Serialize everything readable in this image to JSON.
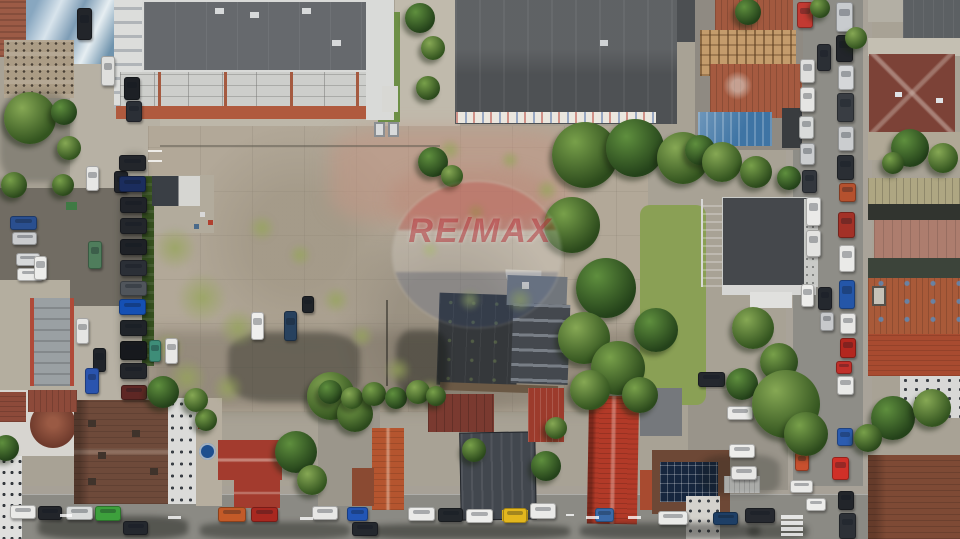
{
  "scene": {
    "type": "aerial-drone-photo",
    "description": "Top-down drone photo of an urban block: large vacant concrete lot in the center with a dark saw-tooth factory roof, a modern apartment building and dark warehouse roof at top, tree-lined vertical streets left and right packed with parked cars, and a row of tiled-roof houses along the bottom street.",
    "watermark": {
      "brand": "RE/MAX"
    }
  },
  "palette": {
    "ground_concrete": "#a8a295",
    "lot_concrete": "#b2a898",
    "lot_pink": "#bb9d8c",
    "asphalt": "#8d8c86",
    "asphalt_dark": "#716c63",
    "roof_apartment": "#66696d",
    "roof_warehouse": "#55585b",
    "roof_office": "#45484c",
    "roof_sawtooth": "#3b3e42",
    "tile_red": "#a4503a",
    "tile_bright": "#b23a28",
    "roof_maroon": "#7c4237",
    "roof_brown": "#6e4a3a",
    "roof_blue": "#3e74a4",
    "vegetation": "#4c7030",
    "grass": "#8aa055",
    "watermark_red": "#ac1e24",
    "car_white": "#eaeae8"
  },
  "structures": [
    {
      "name": "apartment-building",
      "roof": "#66696d"
    },
    {
      "name": "warehouse",
      "roof": "#55585b"
    },
    {
      "name": "vacant-lot",
      "surface": "#b2a898"
    },
    {
      "name": "sawtooth-factory",
      "roof": "#3b3e42"
    },
    {
      "name": "office-building",
      "roof": "#45484c"
    },
    {
      "name": "ruined-tile-buildings",
      "roof": "#a4503a"
    },
    {
      "name": "blue-metal-roof",
      "roof": "#3e74a4"
    },
    {
      "name": "maroon-roof-house",
      "roof": "#7c4237"
    },
    {
      "name": "turret-house",
      "roof": "#6e4a3a"
    },
    {
      "name": "modern-dark-house",
      "roof": "#42474e"
    },
    {
      "name": "red-tile-house",
      "roof": "#b23a28"
    },
    {
      "name": "solar-panel-house",
      "roof": "#6d4836"
    },
    {
      "name": "garage-row",
      "roof": "#9aa0a3"
    }
  ],
  "cars": [
    [
      77,
      8,
      15,
      32,
      "#22252a"
    ],
    [
      101,
      56,
      14,
      30,
      "#dfdfdd"
    ],
    [
      124,
      77,
      16,
      23,
      "#1d2025"
    ],
    [
      126,
      101,
      16,
      21,
      "#2b2f36"
    ],
    [
      86,
      166,
      13,
      25,
      "#e7e7e5"
    ],
    [
      114,
      171,
      14,
      22,
      "#202329"
    ],
    [
      119,
      155,
      27,
      16,
      "#23262b"
    ],
    [
      119,
      176,
      27,
      16,
      "#1b2d5e"
    ],
    [
      120,
      197,
      27,
      16,
      "#202329"
    ],
    [
      120,
      218,
      27,
      16,
      "#23262b"
    ],
    [
      120,
      239,
      27,
      16,
      "#1e2126"
    ],
    [
      120,
      260,
      27,
      16,
      "#2b2f36"
    ],
    [
      120,
      281,
      27,
      15,
      "#50555b"
    ],
    [
      119,
      299,
      27,
      16,
      "#1550b4"
    ],
    [
      120,
      320,
      27,
      16,
      "#202429"
    ],
    [
      120,
      341,
      27,
      19,
      "#17191d"
    ],
    [
      120,
      363,
      27,
      16,
      "#23262b"
    ],
    [
      121,
      385,
      26,
      15,
      "#5e2724"
    ],
    [
      88,
      241,
      14,
      28,
      "#4f7d5c"
    ],
    [
      76,
      318,
      13,
      26,
      "#e5e5e3"
    ],
    [
      93,
      348,
      13,
      24,
      "#20242a"
    ],
    [
      85,
      368,
      14,
      26,
      "#2a54ae"
    ],
    [
      149,
      340,
      12,
      22,
      "#3e8d78"
    ],
    [
      165,
      338,
      13,
      26,
      "#e8e8e6"
    ],
    [
      10,
      216,
      27,
      14,
      "#2a4f8f"
    ],
    [
      12,
      232,
      25,
      13,
      "#caccce"
    ],
    [
      16,
      253,
      24,
      13,
      "#d7d9da"
    ],
    [
      17,
      268,
      26,
      13,
      "#e9e9e7"
    ],
    [
      34,
      256,
      13,
      24,
      "#ededeb"
    ],
    [
      251,
      312,
      13,
      28,
      "#efefed"
    ],
    [
      284,
      311,
      13,
      30,
      "#27415e"
    ],
    [
      302,
      296,
      12,
      17,
      "#1f2328"
    ],
    [
      836,
      2,
      17,
      30,
      "#c8cbce"
    ],
    [
      836,
      35,
      17,
      27,
      "#22252a"
    ],
    [
      838,
      65,
      16,
      25,
      "#d5d7d9"
    ],
    [
      837,
      93,
      17,
      29,
      "#393d43"
    ],
    [
      838,
      126,
      16,
      25,
      "#cbcdcf"
    ],
    [
      837,
      155,
      17,
      25,
      "#2a2e34"
    ],
    [
      839,
      183,
      17,
      19,
      "#b5512e"
    ],
    [
      838,
      212,
      17,
      26,
      "#a33127"
    ],
    [
      839,
      245,
      16,
      27,
      "#eaeae8"
    ],
    [
      839,
      280,
      16,
      29,
      "#2456a8"
    ],
    [
      840,
      313,
      16,
      21,
      "#e7e7e5"
    ],
    [
      840,
      338,
      16,
      20,
      "#b3271f"
    ],
    [
      836,
      361,
      16,
      13,
      "#c0302a"
    ],
    [
      837,
      376,
      17,
      19,
      "#e9e9e7"
    ],
    [
      837,
      428,
      16,
      18,
      "#2b5cb0"
    ],
    [
      832,
      457,
      17,
      23,
      "#d03028"
    ],
    [
      838,
      491,
      16,
      19,
      "#22252a"
    ],
    [
      839,
      513,
      17,
      26,
      "#2d3137"
    ],
    [
      797,
      2,
      16,
      26,
      "#c23a32"
    ],
    [
      800,
      59,
      15,
      24,
      "#dfdfdd"
    ],
    [
      800,
      87,
      15,
      25,
      "#e5e5e3"
    ],
    [
      799,
      116,
      15,
      23,
      "#d9dbda"
    ],
    [
      800,
      143,
      15,
      22,
      "#cbcdcf"
    ],
    [
      802,
      170,
      15,
      23,
      "#33373d"
    ],
    [
      806,
      197,
      15,
      29,
      "#eaeae8"
    ],
    [
      806,
      230,
      15,
      27,
      "#e3e3e1"
    ],
    [
      817,
      44,
      14,
      27,
      "#2b2f35"
    ],
    [
      818,
      287,
      14,
      23,
      "#24282e"
    ],
    [
      820,
      312,
      14,
      19,
      "#c7c9cb"
    ],
    [
      801,
      284,
      13,
      23,
      "#ededeb"
    ],
    [
      795,
      452,
      14,
      19,
      "#c8502e"
    ],
    [
      790,
      480,
      23,
      13,
      "#e9e9e7"
    ],
    [
      806,
      498,
      20,
      13,
      "#ededeb"
    ],
    [
      10,
      505,
      26,
      14,
      "#eaeae8"
    ],
    [
      38,
      506,
      24,
      14,
      "#22252a"
    ],
    [
      66,
      506,
      27,
      14,
      "#d9dbda"
    ],
    [
      95,
      506,
      26,
      15,
      "#3da03c"
    ],
    [
      123,
      521,
      25,
      14,
      "#24282e"
    ],
    [
      218,
      507,
      28,
      15,
      "#c35a28"
    ],
    [
      251,
      507,
      27,
      15,
      "#a82820"
    ],
    [
      312,
      506,
      26,
      14,
      "#e7e7e5"
    ],
    [
      347,
      507,
      21,
      14,
      "#2255b5"
    ],
    [
      352,
      522,
      26,
      14,
      "#24282e"
    ],
    [
      408,
      507,
      27,
      14,
      "#eaeae8"
    ],
    [
      438,
      508,
      25,
      14,
      "#23272c"
    ],
    [
      466,
      509,
      27,
      14,
      "#ededeb"
    ],
    [
      503,
      508,
      24,
      15,
      "#e3b71e"
    ],
    [
      530,
      503,
      26,
      16,
      "#eaeae8"
    ],
    [
      595,
      508,
      19,
      14,
      "#3a6aa8"
    ],
    [
      658,
      511,
      30,
      14,
      "#eaeae8"
    ],
    [
      713,
      512,
      25,
      13,
      "#1e3f66"
    ],
    [
      745,
      508,
      30,
      15,
      "#26292f"
    ],
    [
      698,
      372,
      27,
      15,
      "#25282e"
    ],
    [
      727,
      406,
      26,
      14,
      "#eaeae8"
    ],
    [
      729,
      444,
      26,
      14,
      "#ededeb"
    ],
    [
      731,
      466,
      26,
      14,
      "#e7e7e5"
    ]
  ],
  "trees": [
    [
      30,
      118,
      26
    ],
    [
      14,
      185,
      13
    ],
    [
      64,
      112,
      13
    ],
    [
      69,
      148,
      12
    ],
    [
      63,
      185,
      11
    ],
    [
      420,
      18,
      15
    ],
    [
      433,
      48,
      12
    ],
    [
      428,
      88,
      12
    ],
    [
      433,
      162,
      15
    ],
    [
      452,
      176,
      11
    ],
    [
      585,
      155,
      33
    ],
    [
      635,
      148,
      29
    ],
    [
      683,
      158,
      26
    ],
    [
      572,
      225,
      28
    ],
    [
      606,
      288,
      30
    ],
    [
      584,
      338,
      26
    ],
    [
      618,
      368,
      27
    ],
    [
      656,
      330,
      22
    ],
    [
      590,
      390,
      20
    ],
    [
      640,
      395,
      18
    ],
    [
      700,
      150,
      15
    ],
    [
      722,
      162,
      20
    ],
    [
      756,
      172,
      16
    ],
    [
      789,
      178,
      12
    ],
    [
      753,
      328,
      21
    ],
    [
      779,
      362,
      19
    ],
    [
      742,
      384,
      16
    ],
    [
      786,
      404,
      34
    ],
    [
      806,
      434,
      22
    ],
    [
      910,
      148,
      19
    ],
    [
      943,
      158,
      15
    ],
    [
      893,
      163,
      11
    ],
    [
      893,
      418,
      22
    ],
    [
      932,
      408,
      19
    ],
    [
      868,
      438,
      14
    ],
    [
      296,
      452,
      21
    ],
    [
      312,
      480,
      15
    ],
    [
      206,
      420,
      11
    ],
    [
      6,
      448,
      13
    ],
    [
      331,
      396,
      24
    ],
    [
      355,
      414,
      18
    ],
    [
      546,
      466,
      15
    ],
    [
      556,
      428,
      11
    ],
    [
      474,
      450,
      12
    ],
    [
      748,
      12,
      13
    ],
    [
      856,
      38,
      11
    ],
    [
      820,
      8,
      10
    ],
    [
      330,
      392,
      12
    ],
    [
      352,
      398,
      11
    ],
    [
      374,
      394,
      12
    ],
    [
      396,
      398,
      11
    ],
    [
      418,
      392,
      12
    ],
    [
      436,
      396,
      10
    ],
    [
      163,
      392,
      16
    ],
    [
      196,
      400,
      12
    ]
  ],
  "weeds": [
    [
      175,
      248,
      22
    ],
    [
      202,
      298,
      26
    ],
    [
      238,
      328,
      20
    ],
    [
      168,
      348,
      16
    ],
    [
      187,
      378,
      20
    ],
    [
      228,
      388,
      16
    ],
    [
      262,
      228,
      14
    ],
    [
      300,
      255,
      12
    ],
    [
      336,
      300,
      14
    ],
    [
      450,
      150,
      12
    ],
    [
      476,
      212,
      10
    ],
    [
      520,
      300,
      14
    ],
    [
      470,
      300,
      12
    ],
    [
      430,
      250,
      10
    ],
    [
      547,
      190,
      12
    ],
    [
      362,
      336,
      12
    ],
    [
      398,
      370,
      14
    ],
    [
      430,
      390,
      12
    ],
    [
      510,
      160,
      10
    ]
  ],
  "shadows": [
    [
      228,
      332,
      132,
      70,
      0.35
    ],
    [
      396,
      330,
      52,
      68,
      0.4
    ],
    [
      38,
      516,
      150,
      23,
      0.45
    ],
    [
      200,
      522,
      150,
      17,
      0.4
    ],
    [
      360,
      524,
      210,
      15,
      0.45
    ],
    [
      580,
      523,
      180,
      16,
      0.42
    ],
    [
      748,
      524,
      60,
      15,
      0.4
    ],
    [
      0,
      92,
      72,
      90,
      0.22
    ],
    [
      700,
      455,
      80,
      40,
      0.25
    ],
    [
      118,
      152,
      32,
      248,
      0.16
    ]
  ],
  "marks": [
    [
      781,
      515,
      22,
      4
    ],
    [
      781,
      521,
      22,
      4
    ],
    [
      781,
      527,
      22,
      4
    ],
    [
      781,
      533,
      22,
      3
    ],
    [
      168,
      516,
      13,
      3
    ],
    [
      300,
      517,
      13,
      3
    ],
    [
      586,
      516,
      13,
      3
    ],
    [
      628,
      516,
      13,
      3
    ],
    [
      60,
      514,
      12,
      3
    ],
    [
      148,
      150,
      14,
      2
    ],
    [
      148,
      160,
      14,
      2
    ],
    [
      566,
      514,
      8,
      2
    ]
  ]
}
